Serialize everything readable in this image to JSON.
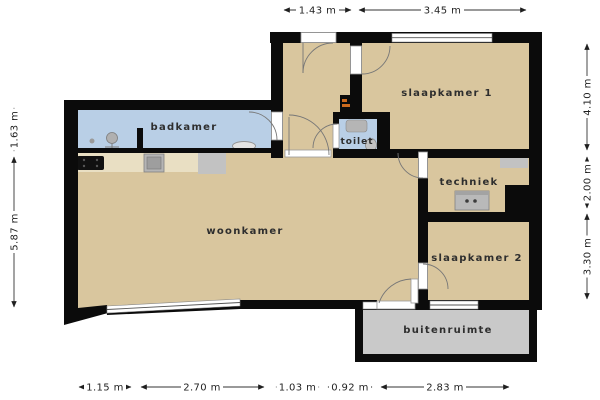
{
  "plan": {
    "rooms": {
      "badkamer": {
        "label": "badkamer"
      },
      "slaapkamer1": {
        "label": "slaapkamer 1"
      },
      "toilet": {
        "label": "toilet"
      },
      "techniek": {
        "label": "techniek"
      },
      "woonkamer": {
        "label": "woonkamer"
      },
      "slaapkamer2": {
        "label": "slaapkamer 2"
      },
      "buitenruimte": {
        "label": "buitenruimte"
      }
    },
    "dimensions": {
      "top": [
        "1.43 m",
        "3.45 m"
      ],
      "bottom": [
        "1.15 m",
        "2.70 m",
        "1.03 m",
        "0.92 m",
        "2.83 m"
      ],
      "left": [
        "1.63 m",
        "5.87 m"
      ],
      "right": [
        "4.10 m",
        "2.00 m",
        "3.30 m"
      ]
    },
    "colors": {
      "wall": "#0b0b0b",
      "floor": "#d9c69e",
      "wet_room": "#b9cfe6",
      "outdoor": "#c9c9c9",
      "counter": "#e9dfc3",
      "appliance": "#c2c2c2",
      "accent": "#cc6a1e",
      "label_text": "#2e2e2e",
      "dimension_text": "#1f1f1f"
    },
    "icons": {
      "badkamer": [
        "shower-icon",
        "drain-icon",
        "washbasin-icon"
      ],
      "toilet": [
        "hand-basin-icon",
        "toilet-bowl-icon"
      ],
      "kitchen": [
        "cooktop-icon",
        "kitchen-sink-icon",
        "refrigerator-icon"
      ],
      "techniek": [
        "washer-icon",
        "vent-unit-icon"
      ],
      "hal": [
        "meter-cabinet-icon"
      ]
    }
  }
}
